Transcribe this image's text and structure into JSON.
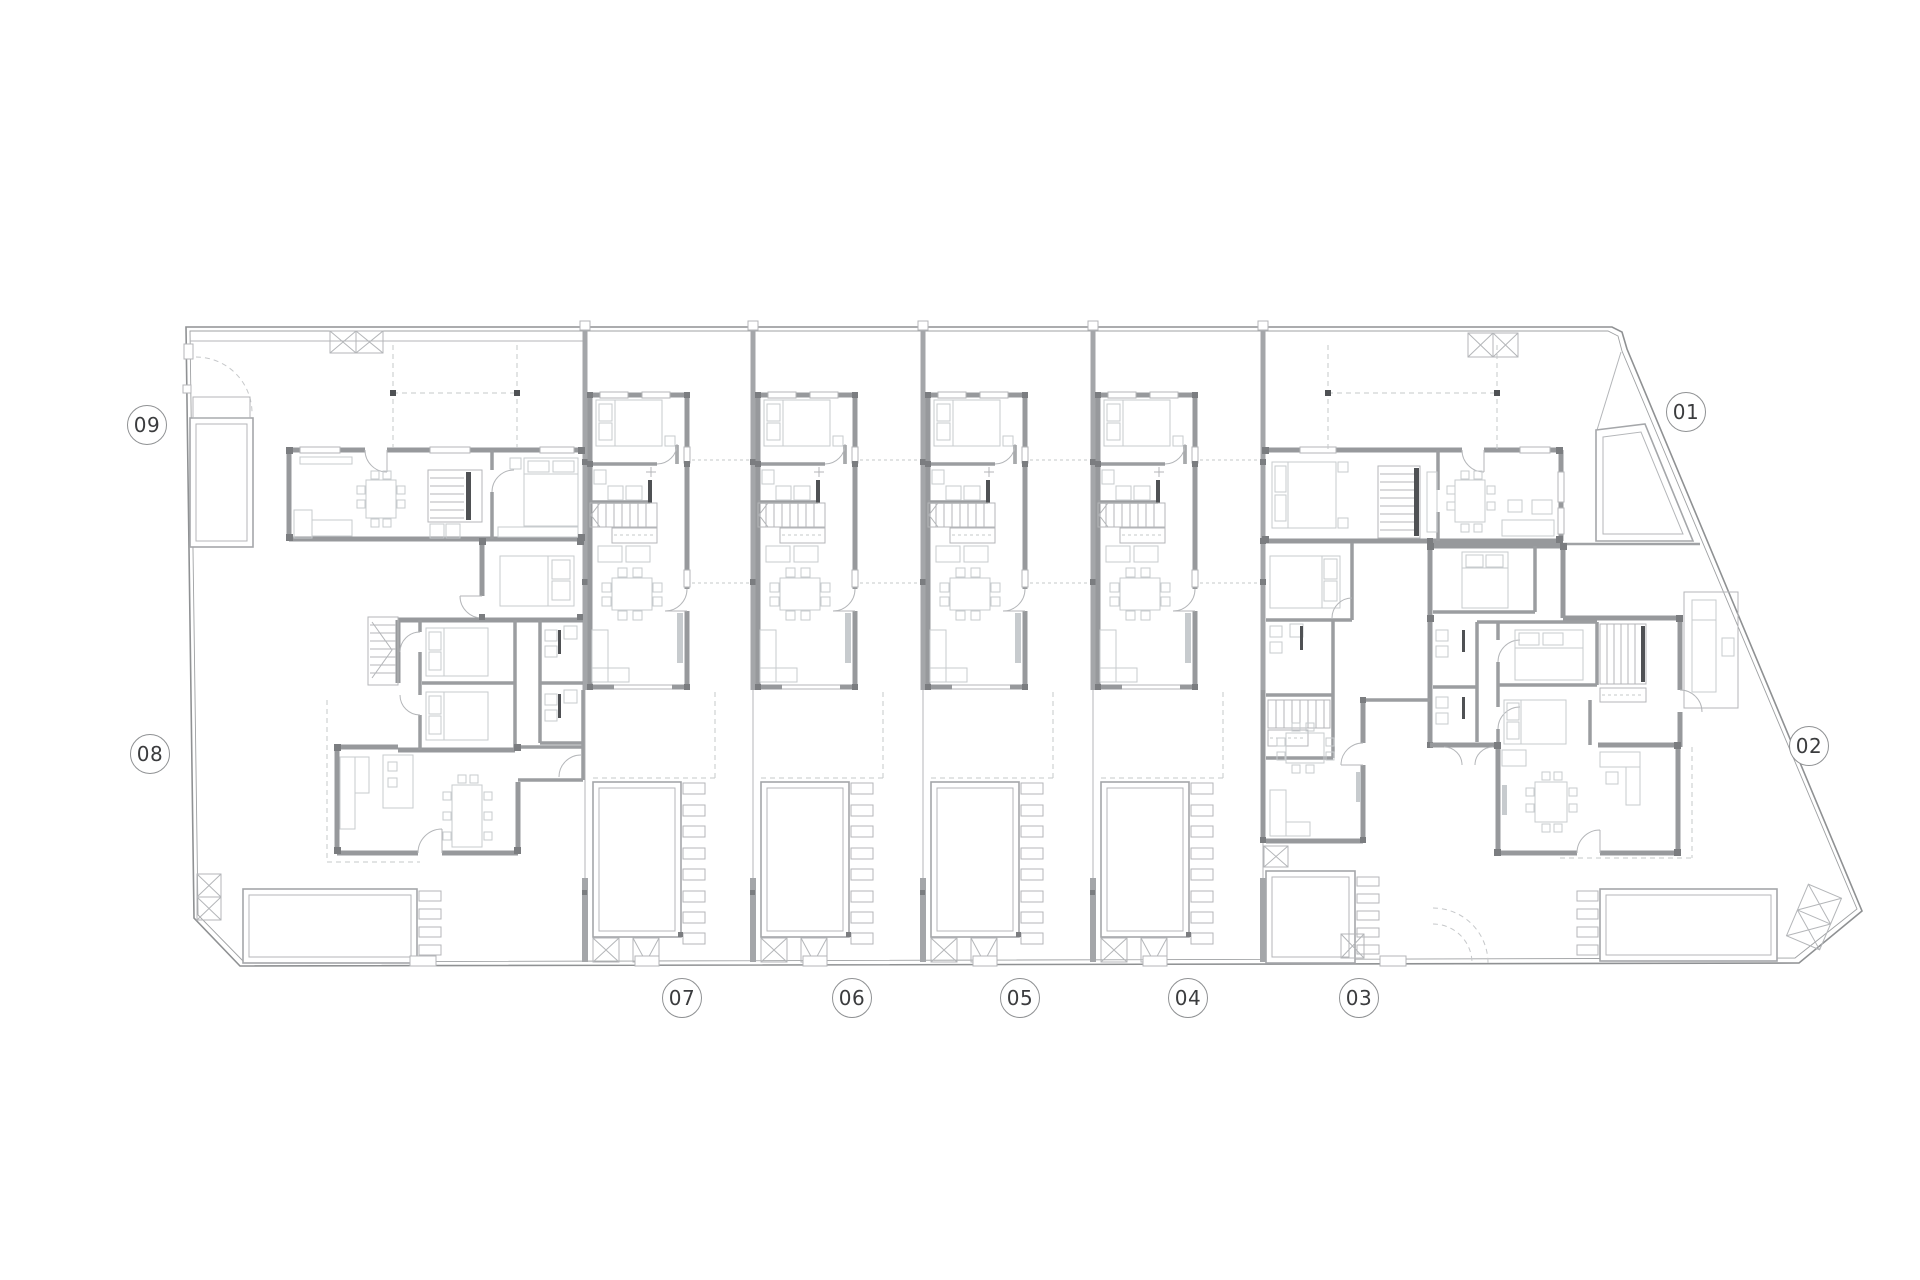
{
  "drawing": {
    "kind": "residential development ground-floor site plan",
    "unit_count": 9
  },
  "unit_labels": [
    {
      "id": "09",
      "cx": 147,
      "cy": 425
    },
    {
      "id": "08",
      "cx": 150,
      "cy": 754
    },
    {
      "id": "01",
      "cx": 1686,
      "cy": 412
    },
    {
      "id": "02",
      "cx": 1809,
      "cy": 746
    },
    {
      "id": "07",
      "cx": 682,
      "cy": 998
    },
    {
      "id": "06",
      "cx": 852,
      "cy": 998
    },
    {
      "id": "05",
      "cx": 1020,
      "cy": 998
    },
    {
      "id": "04",
      "cx": 1188,
      "cy": 998
    },
    {
      "id": "03",
      "cx": 1359,
      "cy": 998
    }
  ],
  "plan": {
    "site_boundary_outer": [
      [
        186,
        327
      ],
      [
        1612,
        327
      ],
      [
        1622,
        332
      ],
      [
        1627,
        349
      ],
      [
        1862,
        911
      ],
      [
        1799,
        963
      ],
      [
        240,
        966
      ],
      [
        194,
        918
      ]
    ],
    "site_boundary_inner": [
      [
        190,
        331
      ],
      [
        1608,
        331
      ],
      [
        1618,
        336
      ],
      [
        1622,
        351
      ],
      [
        1857,
        909
      ],
      [
        1795,
        958
      ],
      [
        244,
        962
      ],
      [
        198,
        915
      ]
    ],
    "lot_divider_x": [
      585,
      753,
      923,
      1093,
      1263
    ],
    "rowhouse_lot_offsets": [
      0,
      168,
      338,
      508
    ]
  },
  "colors": {
    "background": "#ffffff",
    "wall": "#97999c",
    "thin_line": "#b4b6b9",
    "furniture": "#c7cbce",
    "boundary": "#8f9193",
    "dark_fitting": "#4f5154",
    "post": "#7b7d80",
    "label_text": "#3b3c3e",
    "label_ring": "#8f9193"
  }
}
